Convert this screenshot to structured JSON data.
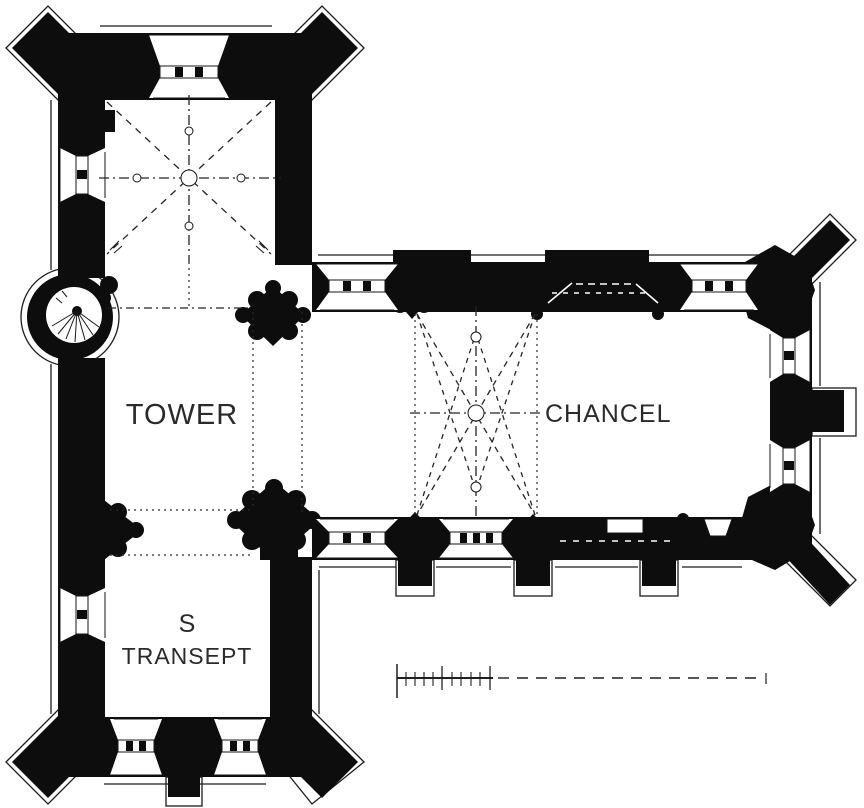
{
  "plan": {
    "labels": {
      "tower": "TOWER",
      "chancel": "CHANCEL",
      "transept_line1": "S",
      "transept_line2": "TRANSEPT"
    },
    "colors": {
      "ink": "#0d0d0d",
      "paper": "#ffffff"
    }
  }
}
